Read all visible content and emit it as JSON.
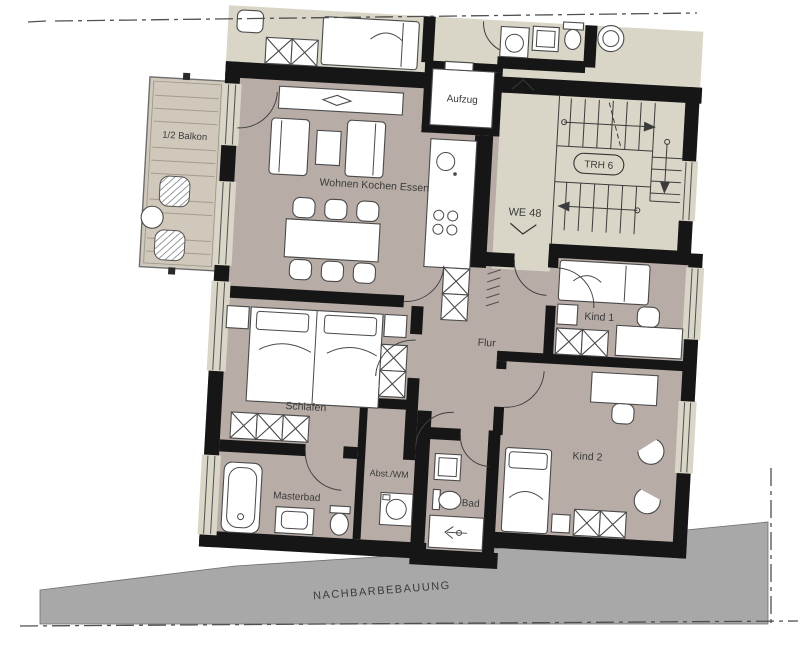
{
  "plan": {
    "title": "Wohnungsgrundriss WE 48",
    "labels": {
      "balcony": "1/2 Balkon",
      "living": "Wohnen Kochen Essen",
      "elevator": "Aufzug",
      "stairwell": "TRH 6",
      "unit": "WE 48",
      "hall": "Flur",
      "bedroom": "Schlafen",
      "master_bath": "Masterbad",
      "storage": "Abst./WM",
      "bath": "Bad",
      "child_room_1": "Kind 1",
      "child_room_2": "Kind 2",
      "neighbor_building": "NACHBARBEBAUUNG"
    },
    "colors": {
      "wall": "#161616",
      "apartment_floor": "#b8ada6",
      "common_floor": "#d9d5c7",
      "balcony_wood": "#cfc8bb",
      "neighbor_area": "#a8a8a8",
      "label_text": "#3a3a3a"
    }
  }
}
